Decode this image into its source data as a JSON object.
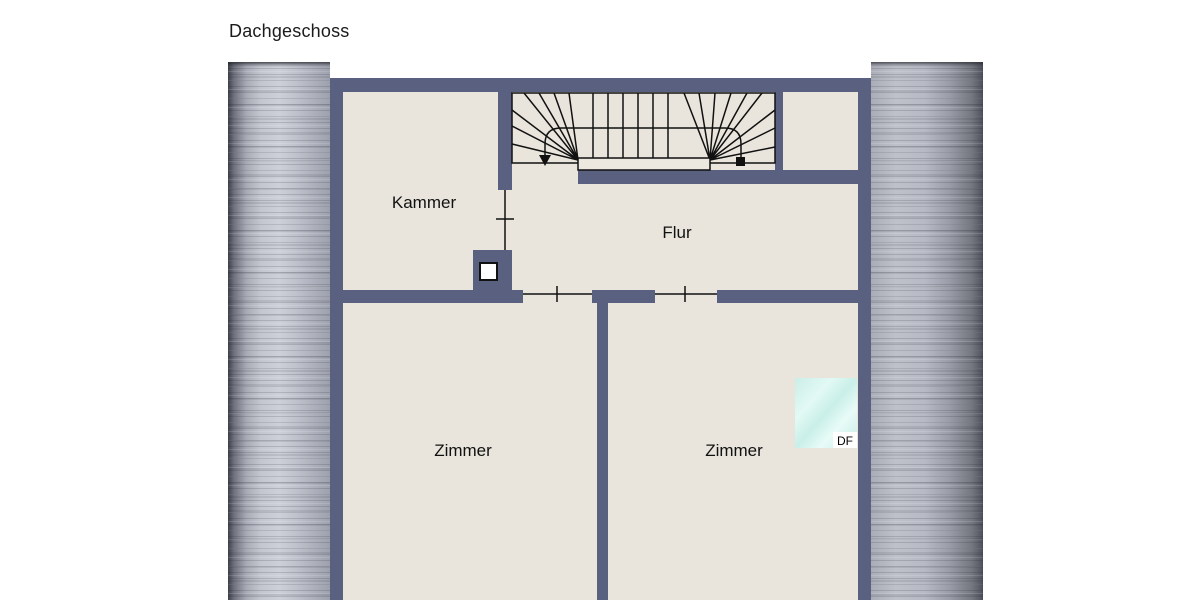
{
  "title": "Dachgeschoss",
  "labels": {
    "kammer": "Kammer",
    "flur": "Flur",
    "zimmer_left": "Zimmer",
    "zimmer_right": "Zimmer",
    "roof_window": "DF"
  },
  "rooms": [
    "Kammer",
    "Flur",
    "Zimmer",
    "Zimmer"
  ],
  "colors": {
    "wall": "#5a6080",
    "floor": "#e9e5dc",
    "outline": "#111111",
    "roof_window_glass": "#d2f1ea",
    "roof_metal_light": "#c6c9d1",
    "roof_metal_dark": "#4a4c55",
    "background": "#ffffff",
    "text": "#1b1b1b"
  }
}
